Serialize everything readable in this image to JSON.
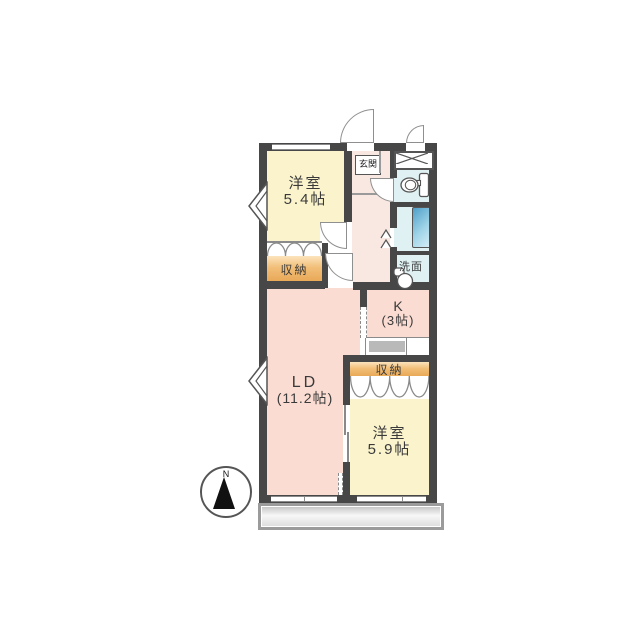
{
  "compass": {
    "north_label": "N"
  },
  "rooms": {
    "bedroom_upper": {
      "name": "洋室",
      "area": "5.4帖"
    },
    "living_dining": {
      "name": "LD",
      "area": "(11.2帖)"
    },
    "kitchen": {
      "name": "K",
      "area": "(3帖)"
    },
    "bedroom_lower": {
      "name": "洋室",
      "area": "5.9帖"
    },
    "entrance": {
      "name": "玄関"
    },
    "washroom": {
      "name": "洗面"
    },
    "storage_upper": {
      "name": "収納"
    },
    "storage_lower": {
      "name": "収納"
    }
  },
  "colors": {
    "wall": "#474747",
    "bedroom_fill": "#faf3cc",
    "living_fill": "#fbdcd2",
    "hall_fill": "#f9e8e1",
    "wet_area_fill": "#dff1f2",
    "storage_fill_dark": "#e9a958",
    "storage_fill_light": "#fce4bd",
    "bathtub_blue": "#4e9fc9",
    "balcony_gray": "#d9d9d9"
  }
}
